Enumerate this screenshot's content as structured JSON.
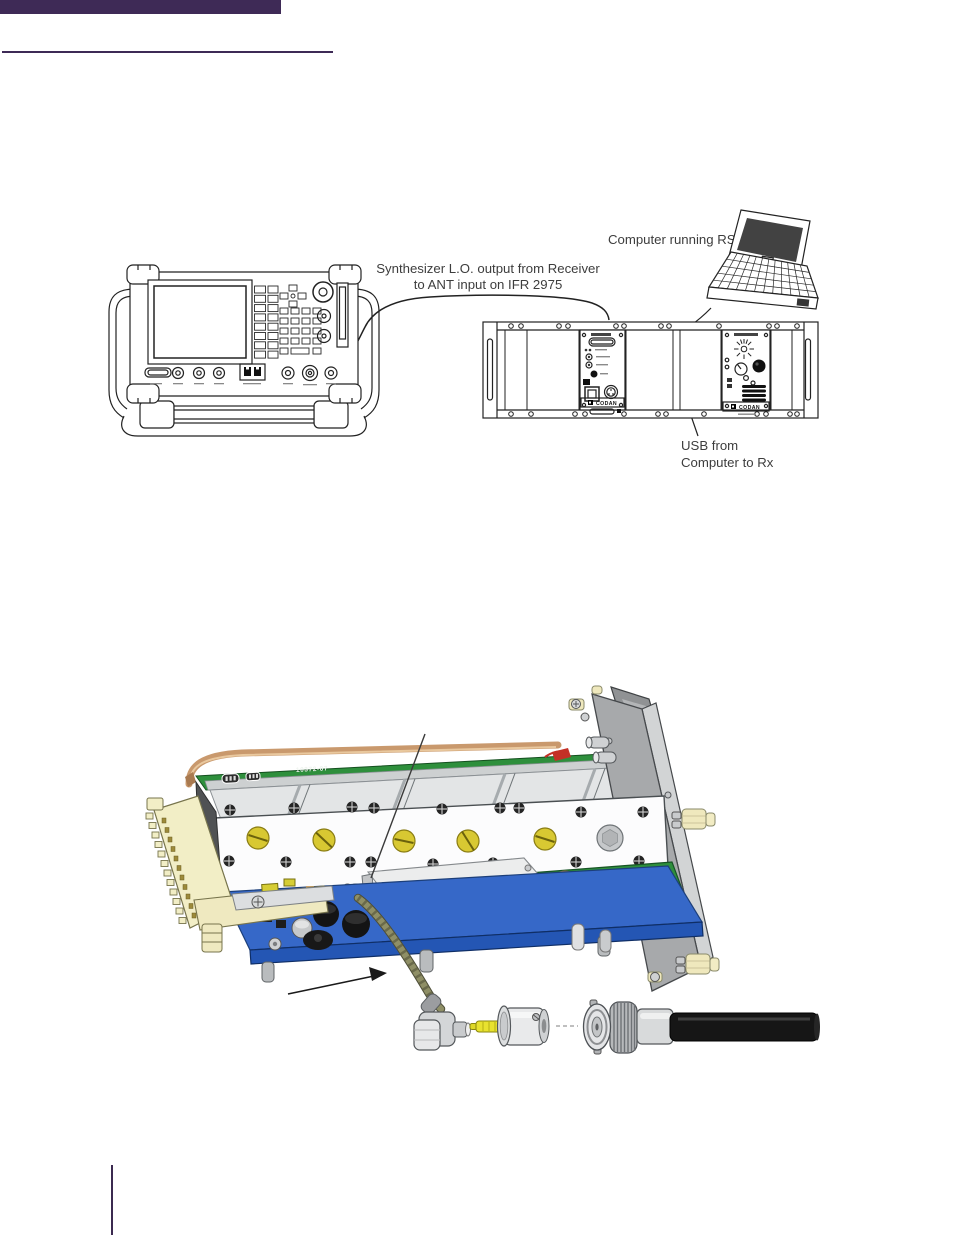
{
  "page": {
    "accent_color": "#3E2A56",
    "background": "#ffffff"
  },
  "setup_diagram": {
    "labels": {
      "computer": "Computer running RSS",
      "synthesizer_line1": "Synthesizer L.O. output from Receiver",
      "synthesizer_line2": "to ANT input on IFR 2975",
      "usb_line1": "USB from",
      "usb_line2": "Computer to Rx"
    },
    "rack": {
      "brand": "CODAN"
    }
  },
  "module_illustration": {
    "pcb_marking": "10372-07"
  }
}
